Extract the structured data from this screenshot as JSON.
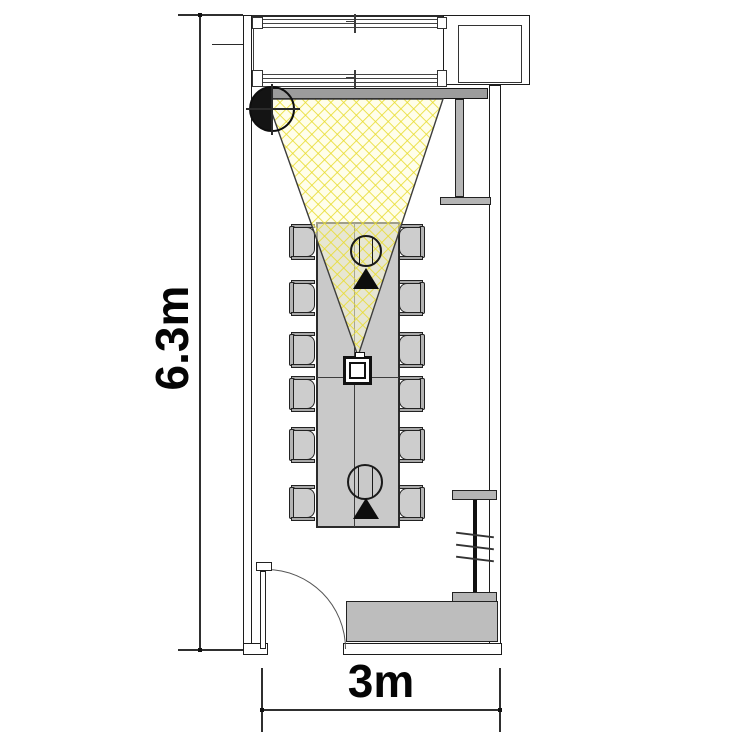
{
  "diagram": {
    "type": "floor-plan",
    "subject": "meeting room plan with camera field-of-view cone, conference table and seating",
    "dimension_labels": {
      "height": "6.3m",
      "width": "3m"
    },
    "room": {
      "height_meters": 6.3,
      "width_meters": 3
    },
    "furniture": {
      "conference_table": 1,
      "chairs_count": 12,
      "chairs_per_side": 6,
      "credenza": 1,
      "wall_screens": 2,
      "door": 1
    },
    "symbols": {
      "camera_position_marker": "circle with crosshair, left half filled black",
      "camera_fov_cone": "yellow crosshatched triangle from device on table toward top wall",
      "participant_markers": 2,
      "view_direction_triangles": 2,
      "table_device": "square speakerphone/camera at cone apex"
    },
    "colors": {
      "cone_hatch_line": "#e8dc2e",
      "cone_background": "rgba(255,253,216,0.55)",
      "table_fill": "#c9c9c9",
      "chair_fill": "#cdcdcd",
      "credenza_fill": "#bdbdbd",
      "media_bar_fill": "#9c9c9c",
      "wall_stroke": "#1c1c1c",
      "text_color": "#050505"
    }
  }
}
